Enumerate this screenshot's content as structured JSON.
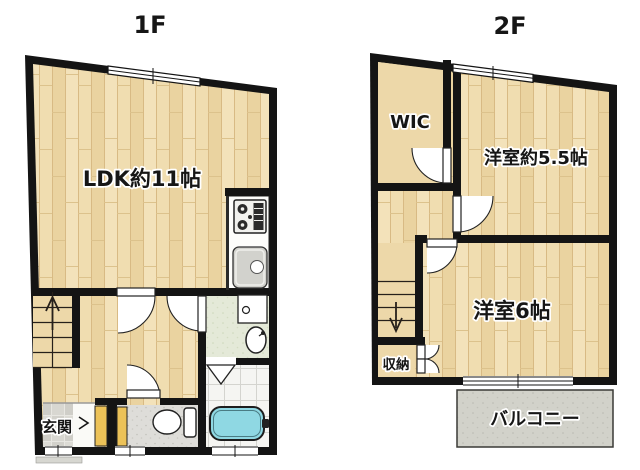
{
  "floor1": {
    "title": "1F",
    "rooms": {
      "ldk": "LDK約11帖",
      "genkan": "玄関"
    }
  },
  "floor2": {
    "title": "2F",
    "rooms": {
      "wic": "WIC",
      "western_55": "洋室約5.5帖",
      "western_6": "洋室6帖",
      "storage": "収納",
      "balcony": "バルコニー"
    }
  },
  "icons": {
    "stove": "gas-stove-icon",
    "kitchen_sink": "kitchen-sink-icon",
    "washing_machine": "washing-machine-icon",
    "washbasin": "washbasin-icon",
    "toilet": "toilet-icon",
    "bathtub": "bathtub-icon",
    "bath_door": "folding-door-icon",
    "stairs_up": "stairs-up-arrow-icon",
    "stairs_down": "stairs-down-arrow-icon"
  },
  "colors": {
    "wall": "#141414",
    "wood_floor": "#efdcae",
    "plain_floor": "#edd8a9",
    "washroom_floor": "#e4e9d8",
    "bath_tile": "#f5f5f2",
    "toilet_floor": "#deddd9",
    "genkan_tile": "#d6d5d0",
    "balcony_floor": "#d2d2ca",
    "shoe_cabinet": "#ecc258",
    "bathtub": "#8fd8e3"
  }
}
